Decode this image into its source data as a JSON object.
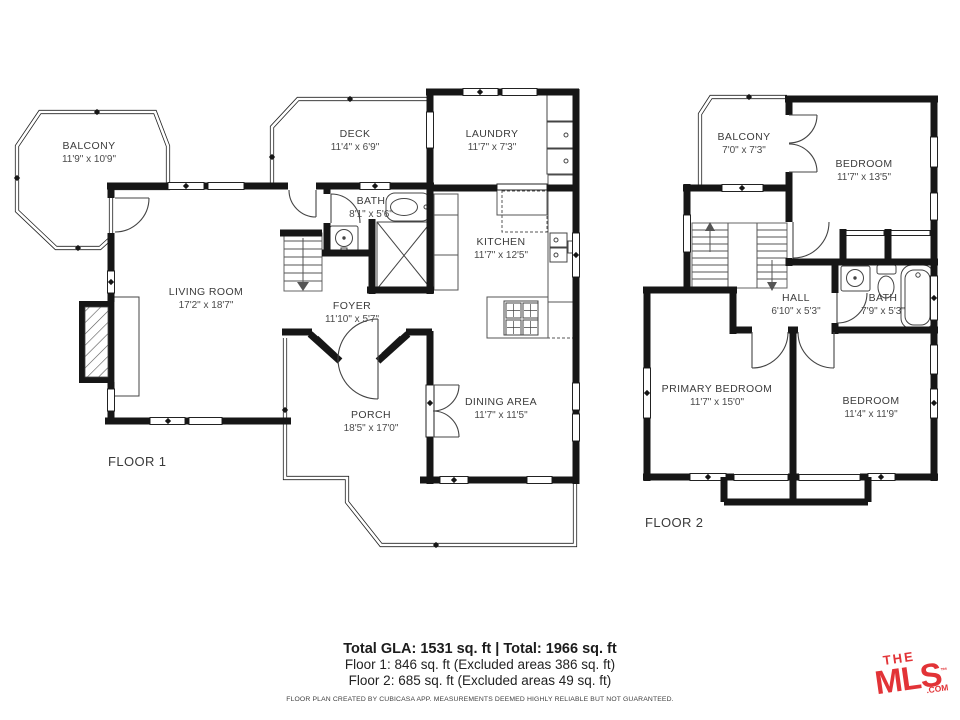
{
  "floor1": {
    "label": "FLOOR 1",
    "rooms": [
      {
        "name": "BALCONY",
        "dims": "11'9\" x 10'9\""
      },
      {
        "name": "DECK",
        "dims": "11'4\" x 6'9\""
      },
      {
        "name": "LAUNDRY",
        "dims": "11'7\" x 7'3\""
      },
      {
        "name": "BATH",
        "dims": "8'1\" x 5'6\""
      },
      {
        "name": "KITCHEN",
        "dims": "11'7\" x 12'5\""
      },
      {
        "name": "LIVING ROOM",
        "dims": "17'2\" x 18'7\""
      },
      {
        "name": "FOYER",
        "dims": "11'10\" x 5'7\""
      },
      {
        "name": "PORCH",
        "dims": "18'5\" x 17'0\""
      },
      {
        "name": "DINING AREA",
        "dims": "11'7\" x 11'5\""
      }
    ]
  },
  "floor2": {
    "label": "FLOOR 2",
    "rooms": [
      {
        "name": "BALCONY",
        "dims": "7'0\" x 7'3\""
      },
      {
        "name": "BEDROOM",
        "dims": "11'7\" x 13'5\""
      },
      {
        "name": "HALL",
        "dims": "6'10\" x 5'3\""
      },
      {
        "name": "BATH",
        "dims": "7'9\" x 5'3\""
      },
      {
        "name": "PRIMARY BEDROOM",
        "dims": "11'7\" x 15'0\""
      },
      {
        "name": "BEDROOM",
        "dims": "11'4\" x 11'9\""
      }
    ]
  },
  "summary": {
    "total": "Total GLA: 1531 sq. ft | Total: 1966 sq. ft",
    "floor1_area": "Floor 1: 846 sq. ft (Excluded areas 386 sq. ft)",
    "floor2_area": "Floor 2: 685 sq. ft (Excluded areas 49 sq. ft)",
    "disclaimer": "FLOOR PLAN CREATED BY CUBICASA APP. MEASUREMENTS DEEMED HIGHLY RELIABLE BUT NOT GUARANTEED."
  },
  "logo": {
    "the": "THE",
    "mls": "MLS",
    "tm": "™",
    "com": ".COM",
    "color": "#e23337"
  }
}
